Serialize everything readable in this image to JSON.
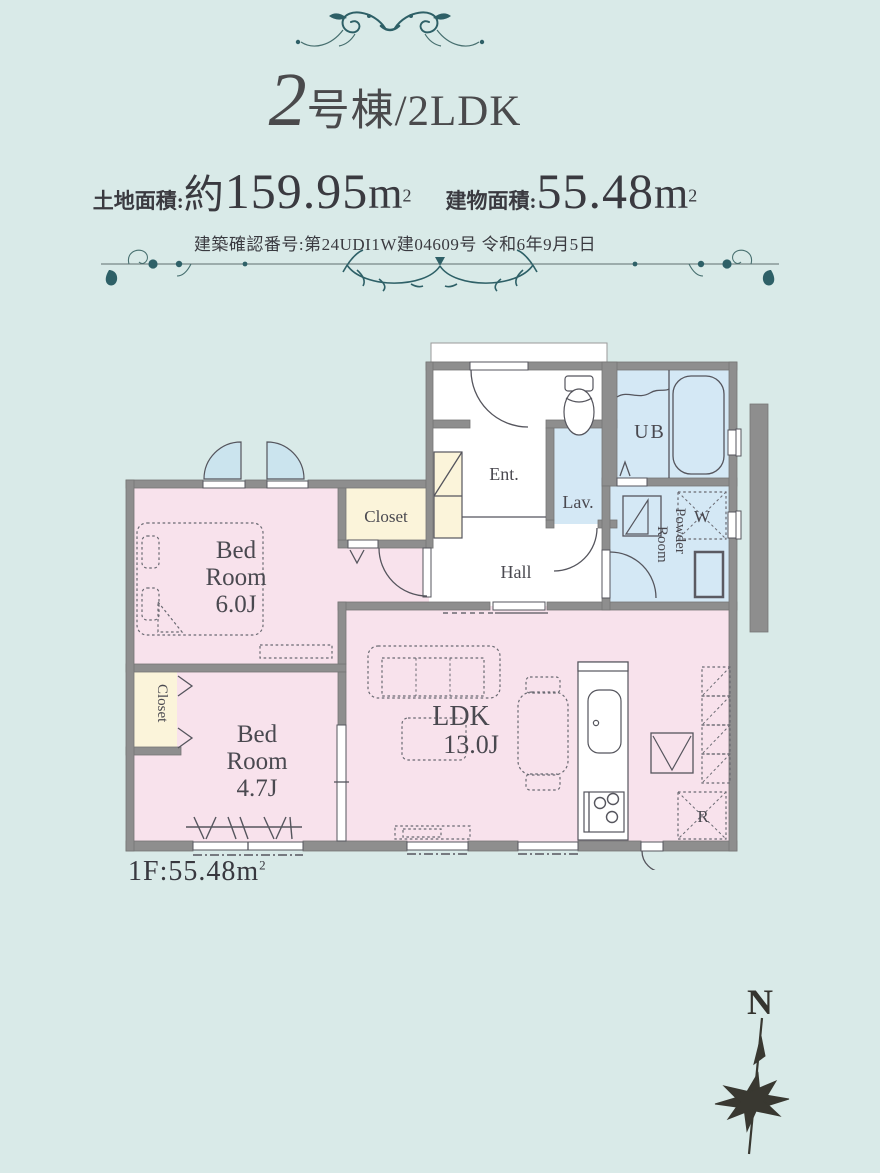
{
  "header": {
    "title_number": "2",
    "title_suffix": "号棟/2LDK",
    "land_label": "土地面積:",
    "land_approx": "約",
    "land_value": "159.95",
    "land_unit": "m",
    "land_unit_sup": "2",
    "building_label": "建物面積:",
    "building_value": "55.48",
    "building_unit": "m",
    "building_unit_sup": "2",
    "confirmation": "建築確認番号:第24UDI1W建04609号 令和6年9月5日"
  },
  "plan": {
    "rooms": {
      "bedroom1": {
        "l1": "Bed",
        "l2": "Room",
        "l3": "6.0J"
      },
      "bedroom2": {
        "l1": "Bed",
        "l2": "Room",
        "l3": "4.7J"
      },
      "ldk": {
        "l1": "LDK",
        "l2": "13.0J"
      },
      "closet1": "Closet",
      "closet2": "Closet",
      "entrance": "Ent.",
      "hall": "Hall",
      "lavatory": "Lav.",
      "bath": "UB",
      "powder_l1": "Powder",
      "powder_l2": "Room",
      "washer": "W",
      "refrigerator": "R"
    },
    "floor_label_prefix": "1F:",
    "floor_area": "55.48",
    "floor_unit": "m",
    "floor_unit_sup": "2"
  },
  "compass": {
    "north": "N"
  },
  "colors": {
    "background": "#d9eae8",
    "wall": "#8e8e8e",
    "room_pink": "#f8e2ec",
    "room_blue": "#d4e8f5",
    "window_fan_blue": "#cbe4ee",
    "closet_cream": "#fbf4da",
    "accent_teal": "#2e6067",
    "text": "#44444b"
  }
}
